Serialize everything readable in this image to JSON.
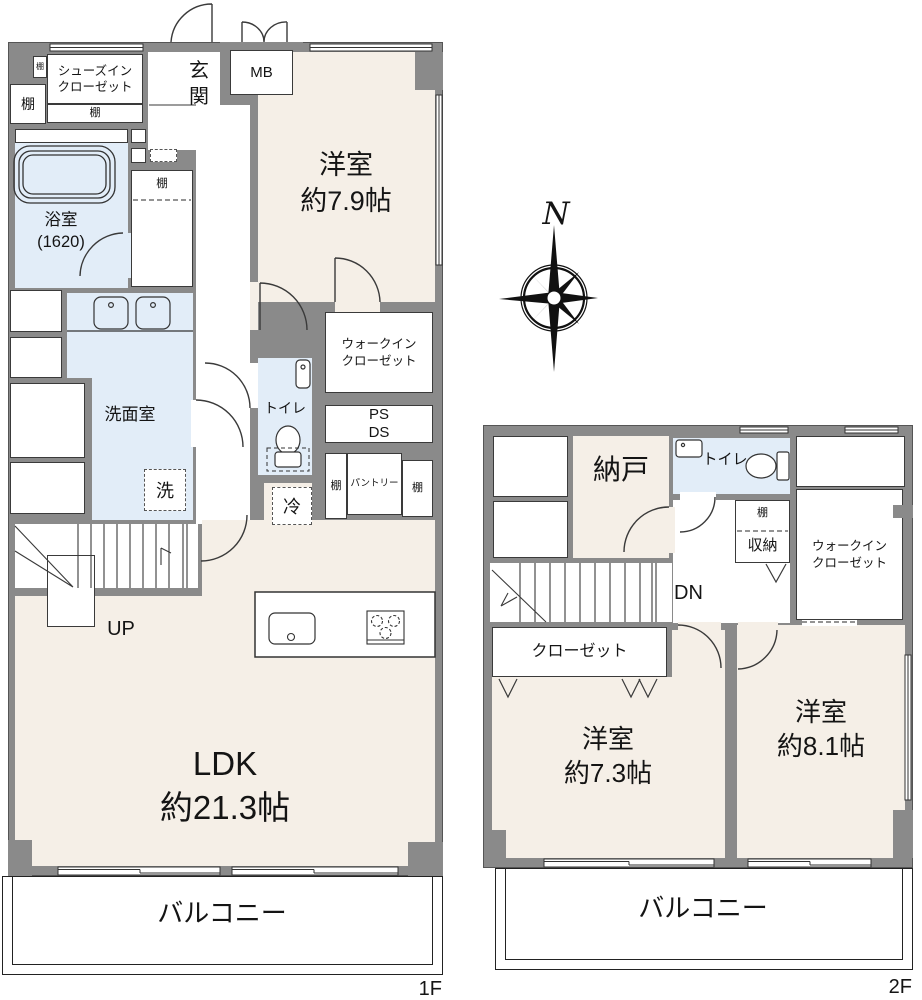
{
  "colors": {
    "wall": "#8a8a8a",
    "room": "#f5efe7",
    "wet": "#e2edf8",
    "line": "#3a3a3a"
  },
  "compass": {
    "north": "N"
  },
  "floor1": {
    "label": "1F",
    "entrance": "玄\n関",
    "shoes_in_closet": "シューズイン\nクローゼット",
    "shelf": "棚",
    "meter_box": "MB",
    "western_room": "洋室\n約7.9帖",
    "bathroom": "浴室\n(1620)",
    "washroom": "洗面室",
    "laundry": "洗",
    "toilet": "トイレ",
    "walk_in_closet": "ウォークイン\nクローゼット",
    "pipe_space": "PS\nDS",
    "pantry": "パントリー",
    "fridge": "冷",
    "stairs_up": "UP",
    "ldk": "LDK\n約21.3帖",
    "balcony": "バルコニー"
  },
  "floor2": {
    "label": "2F",
    "storage_room": "納戸",
    "toilet": "トイレ",
    "shelf": "棚",
    "storage": "収納",
    "walk_in_closet": "ウォークイン\nクローゼット",
    "stairs_down": "DN",
    "closet": "クローゼット",
    "western_room_a": "洋室\n約7.3帖",
    "western_room_b": "洋室\n約8.1帖",
    "balcony": "バルコニー"
  }
}
